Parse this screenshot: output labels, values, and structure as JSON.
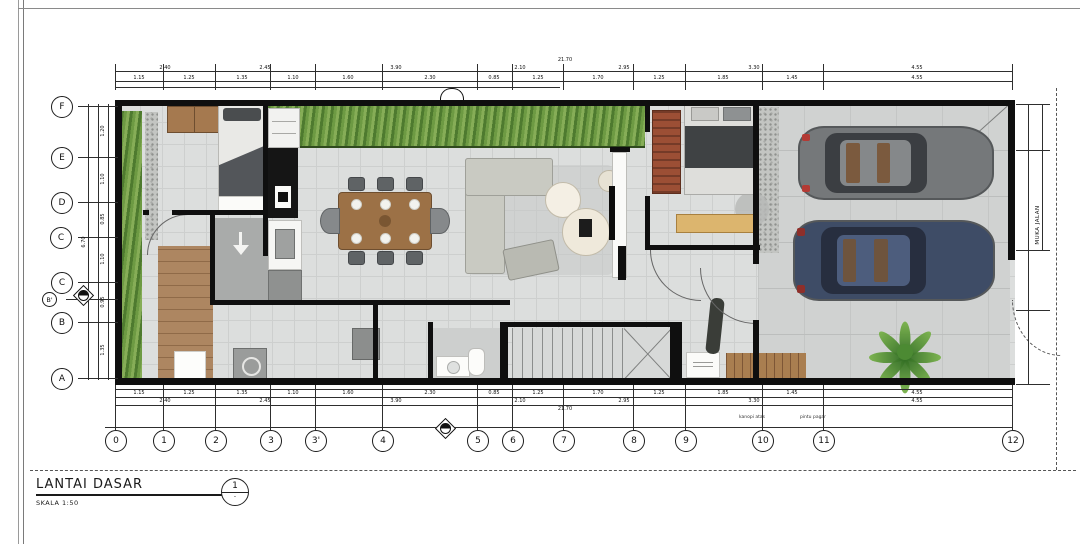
{
  "drawing": {
    "title": "LANTAI DASAR",
    "scale_label": "SKALA 1:50",
    "detail_bubble_number": "1",
    "detail_bubble_sub": "-"
  },
  "grid": {
    "rows": [
      "F",
      "E",
      "D",
      "C",
      "C",
      "B'",
      "B",
      "A"
    ],
    "cols": [
      "0",
      "1",
      "2",
      "3",
      "3'",
      "4",
      "5",
      "6",
      "7",
      "8",
      "9",
      "10",
      "11",
      "12"
    ]
  },
  "dimensions": {
    "top_total": "21.70",
    "top_spans": [
      "2.40",
      "2.45",
      "3.90",
      "2.10",
      "2.95",
      "3.30",
      "4.55"
    ],
    "top_segments": [
      "1.15",
      "1.25",
      "1.35",
      "1.10",
      "1.60",
      "2.30",
      "0.85",
      "1.25",
      "1.70",
      "1.25",
      "1.85",
      "1.45",
      "4.55"
    ],
    "bottom_segments": [
      "1.15",
      "1.25",
      "1.35",
      "1.10",
      "1.60",
      "2.30",
      "0.85",
      "1.25",
      "1.70",
      "1.25",
      "1.85",
      "1.45",
      "4.55"
    ],
    "bottom_spans": [
      "2.40",
      "2.45",
      "3.90",
      "2.10",
      "2.95",
      "3.30",
      "4.55"
    ],
    "bottom_total": "21.70",
    "left_segments": [
      "1.20",
      "1.10",
      "0.85",
      "1.10",
      "0.95",
      "1.35"
    ],
    "left_total": "6.70",
    "right_annotation": "MUKA JALAN"
  },
  "notes": {
    "above_grid_10": "kanopi atas",
    "above_grid_11": "pintu pagar"
  },
  "colors": {
    "wall": "#0f0f0f",
    "floor_tile": "#dcdedd",
    "hedge_green": "#6d9a43",
    "wood": "#ab8260",
    "car_gray": "#75787a",
    "car_navy": "#3e4c66",
    "wardrobe_red": "#9c4f35"
  }
}
